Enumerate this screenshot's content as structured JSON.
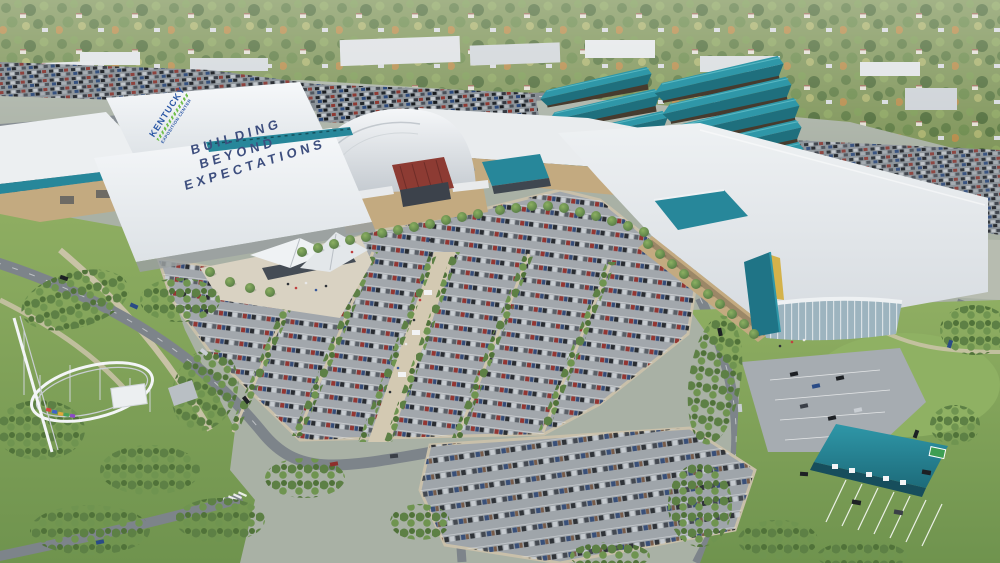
{
  "scene": {
    "type": "aerial-architectural-rendering",
    "caption": "Aerial rendering of an exposition center campus: white exhibit-hall roofs with rooftop lettering, a domed arena with red entrance canopy, teal open-air pavilions and entrance canopies, tree-lined parking lots full of cars, an amusement-park roller coaster at left, and a suburban tree line on the horizon"
  },
  "roof_logo": {
    "line1": "KENTUCKY",
    "line2": "EXPOSITION CENTER"
  },
  "roof_slogan": {
    "line1": "BUILDING",
    "line2": "BEYOND",
    "line3": "EXPECTATIONS"
  },
  "palette": {
    "teal_accent": "#27879a",
    "pavilion_teal": "#2f97a8",
    "roof_white": "#eef1f3",
    "facade_tan": "#c3aa80",
    "arena_canopy_red": "#8d3b33",
    "slogan_blue": "#3d4e7e",
    "logo_blue": "#2b57a5",
    "logo_green": "#6fbe4a",
    "asphalt_gray": "#9aa1a7",
    "grass_green": "#7fa258",
    "tree_green": "#5d8045"
  }
}
